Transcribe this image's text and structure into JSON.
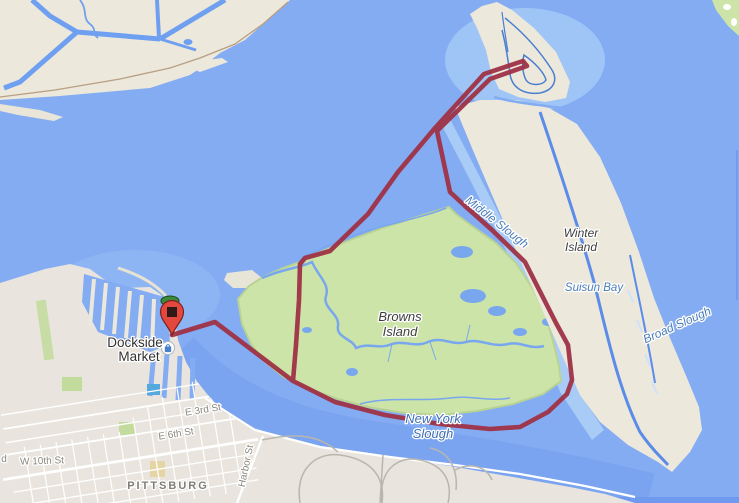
{
  "map": {
    "poi": {
      "name_line1": "Dockside",
      "name_line2": "Market",
      "icon": "shopping-bag-icon"
    },
    "labels": {
      "browns1": "Browns",
      "browns2": "Island",
      "winter1": "Winter",
      "winter2": "Island",
      "middle_slough": "Middle Slough",
      "suisun_bay": "Suisun Bay",
      "broad_slough": "Broad Slough",
      "newyork1": "New York",
      "newyork2": "Slough",
      "city": "PITTSBURG",
      "e3rd": "E 3rd St",
      "e6th": "E 6th St",
      "w10th": "W 10th St",
      "harbor": "Harbor St",
      "partial_left": "d"
    },
    "route": {
      "color": "#9e3145",
      "points": [
        [
          172,
          335
        ],
        [
          215,
          322
        ],
        [
          293,
          381
        ],
        [
          335,
          402
        ],
        [
          385,
          415
        ],
        [
          440,
          424
        ],
        [
          490,
          429
        ],
        [
          520,
          427
        ],
        [
          548,
          412
        ],
        [
          567,
          394
        ],
        [
          572,
          380
        ],
        [
          568,
          345
        ],
        [
          556,
          323
        ],
        [
          525,
          262
        ],
        [
          492,
          230
        ],
        [
          465,
          206
        ],
        [
          450,
          192
        ],
        [
          437,
          131
        ],
        [
          490,
          79
        ],
        [
          527,
          66
        ],
        [
          523,
          61
        ],
        [
          484,
          74
        ],
        [
          435,
          128
        ],
        [
          398,
          172
        ],
        [
          368,
          214
        ],
        [
          330,
          251
        ],
        [
          305,
          258
        ],
        [
          300,
          264
        ],
        [
          299,
          300
        ],
        [
          296,
          345
        ],
        [
          293,
          381
        ]
      ]
    },
    "marker": {
      "color": "#e2483d",
      "x": 172,
      "y": 335
    },
    "colors": {
      "water": "#84acf2",
      "shallow_water": "#a9ccf7",
      "land": "#ece8dc",
      "island_green": "#cde4a9",
      "route": "#9e3145",
      "marker_red": "#e2483d",
      "channel_blue": "#6f9ff0"
    }
  }
}
